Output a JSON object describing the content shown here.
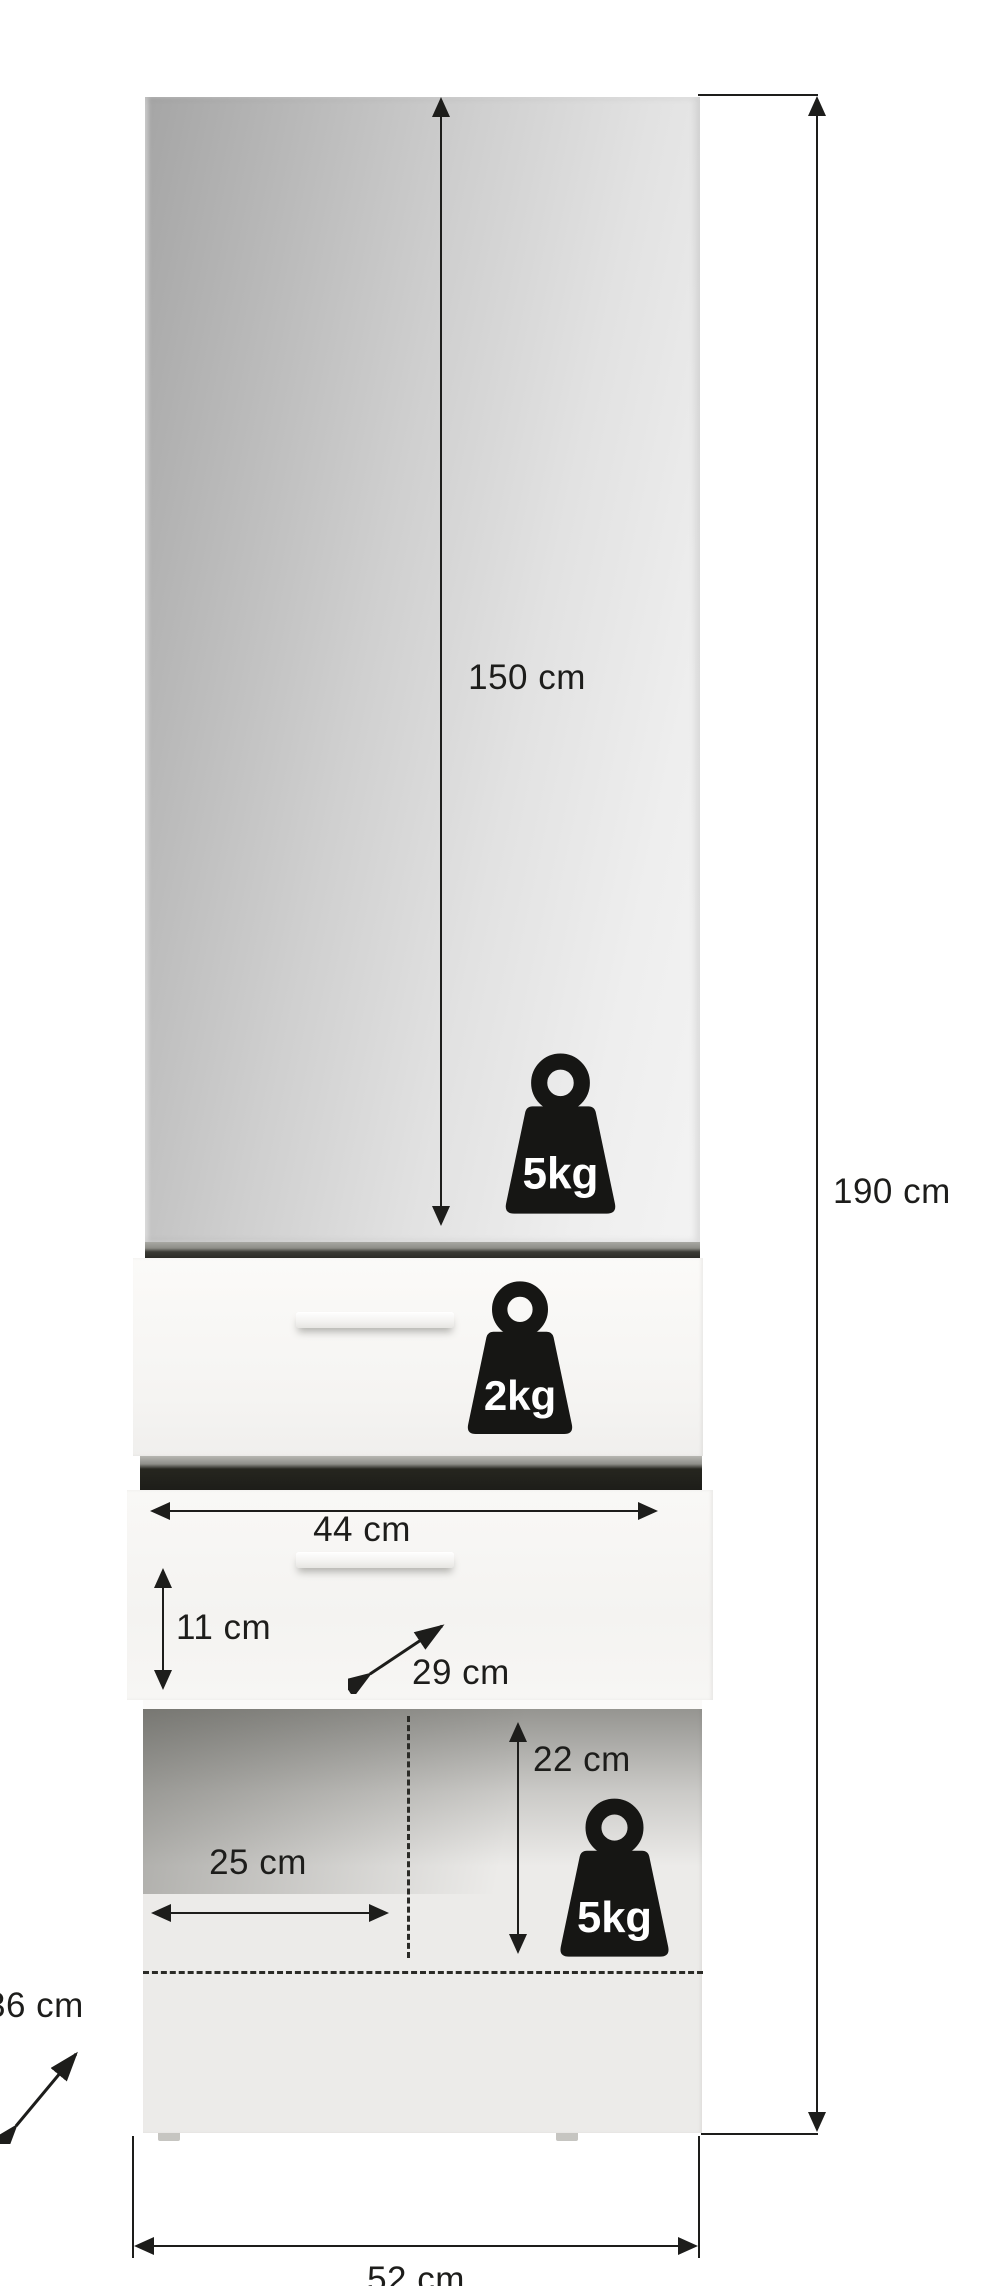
{
  "meta": {
    "title": "Cabinet dimension diagram",
    "product": "Tall cabinet with mirror door, two drawers and open compartment"
  },
  "canvas": {
    "width": 984,
    "height": 2286,
    "background": "#ffffff"
  },
  "palette": {
    "line": "#1d1d1b",
    "label_text": "#1d1d1b",
    "weight_icon_fill": "#161614",
    "weight_icon_text": "#ffffff",
    "mirror_gradient_from": "#a5a5a5",
    "mirror_gradient_to": "#f3f3f3",
    "front_color": "#f7f6f4",
    "gap_dark": "#23231f",
    "niche_color": "#ecebe9"
  },
  "dimensions": {
    "door_height": {
      "label": "150 cm",
      "orientation": "vertical"
    },
    "total_height": {
      "label": "190 cm",
      "orientation": "vertical"
    },
    "drawer_width": {
      "label": "44 cm",
      "orientation": "horizontal"
    },
    "drawer_front_height": {
      "label": "11 cm",
      "orientation": "vertical"
    },
    "drawer_depth": {
      "label": "29 cm",
      "orientation": "diagonal"
    },
    "niche_height": {
      "label": "22 cm",
      "orientation": "vertical"
    },
    "niche_width": {
      "label": "25 cm",
      "orientation": "horizontal"
    },
    "cabinet_depth": {
      "label": "36 cm",
      "orientation": "diagonal"
    },
    "total_width": {
      "label": "52 cm",
      "orientation": "horizontal"
    }
  },
  "load_capacities": {
    "door_shelf": "5kg",
    "top_drawer": "2kg",
    "open_compartment": "5kg"
  }
}
